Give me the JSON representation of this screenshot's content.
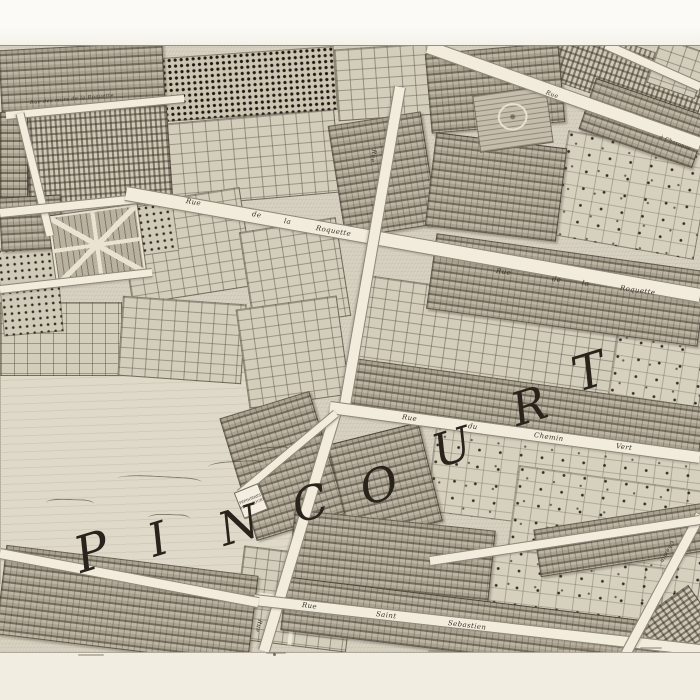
{
  "map": {
    "district_word": "PINCOURT",
    "letters": [
      {
        "ch": "P",
        "x": 92,
        "y": 552,
        "size": 50,
        "rot": -17
      },
      {
        "ch": "I",
        "x": 158,
        "y": 539,
        "size": 46,
        "rot": -17
      },
      {
        "ch": "N",
        "x": 239,
        "y": 525,
        "size": 46,
        "rot": -17
      },
      {
        "ch": "C",
        "x": 310,
        "y": 503,
        "size": 46,
        "rot": -17
      },
      {
        "ch": "O",
        "x": 379,
        "y": 485,
        "size": 46,
        "rot": -17
      },
      {
        "ch": "U",
        "x": 452,
        "y": 447,
        "size": 46,
        "rot": -17
      },
      {
        "ch": "R",
        "x": 529,
        "y": 406,
        "size": 46,
        "rot": -17
      },
      {
        "ch": "T",
        "x": 589,
        "y": 372,
        "size": 48,
        "rot": -17
      }
    ],
    "streets": [
      {
        "name": "Rue des murs de la Roquette",
        "x1": 6,
        "y1": 114,
        "x2": 184,
        "y2": 97,
        "w": 7
      },
      {
        "name": "",
        "x1": 20,
        "y1": 112,
        "x2": 50,
        "y2": 234,
        "w": 7
      },
      {
        "name": "",
        "x1": 0,
        "y1": 212,
        "x2": 148,
        "y2": 197,
        "w": 8
      },
      {
        "name": "",
        "x1": 0,
        "y1": 288,
        "x2": 152,
        "y2": 271,
        "w": 7
      },
      {
        "name": "Rue de la Roquette",
        "x1": 126,
        "y1": 192,
        "x2": 700,
        "y2": 294,
        "w": 13
      },
      {
        "name": "",
        "x1": 428,
        "y1": 46,
        "x2": 700,
        "y2": 143,
        "w": 12
      },
      {
        "name": "",
        "x1": 606,
        "y1": 44,
        "x2": 700,
        "y2": 86,
        "w": 8
      },
      {
        "name": "",
        "x1": 400,
        "y1": 86,
        "x2": 345,
        "y2": 404,
        "w": 10
      },
      {
        "name": "",
        "x1": 338,
        "y1": 404,
        "x2": 264,
        "y2": 650,
        "w": 10
      },
      {
        "name": "Rue du Chemin Vert",
        "x1": 330,
        "y1": 406,
        "x2": 700,
        "y2": 456,
        "w": 11
      },
      {
        "name": "Rue Saint Sebastien",
        "x1": 254,
        "y1": 599,
        "x2": 700,
        "y2": 649,
        "w": 10
      },
      {
        "name": "",
        "x1": 0,
        "y1": 552,
        "x2": 258,
        "y2": 601,
        "w": 9
      },
      {
        "name": "Chemin",
        "x1": 626,
        "y1": 652,
        "x2": 700,
        "y2": 514,
        "w": 9
      },
      {
        "name": "",
        "x1": 240,
        "y1": 492,
        "x2": 336,
        "y2": 412,
        "w": 7
      },
      {
        "name": "",
        "x1": 430,
        "y1": 560,
        "x2": 700,
        "y2": 519,
        "w": 8
      }
    ],
    "labels": [
      {
        "text": "Rue des murs de la Roquette",
        "x": 30,
        "y": 100,
        "rot": -5,
        "size": 5
      },
      {
        "text": "Rue",
        "x": 186,
        "y": 197,
        "rot": 10,
        "size": 7
      },
      {
        "text": "de",
        "x": 252,
        "y": 210,
        "rot": 10,
        "size": 7
      },
      {
        "text": "la",
        "x": 284,
        "y": 217,
        "rot": 10,
        "size": 7
      },
      {
        "text": "Roquette",
        "x": 316,
        "y": 224,
        "rot": 10,
        "size": 7
      },
      {
        "text": "Rue",
        "x": 496,
        "y": 267,
        "rot": 8,
        "size": 7
      },
      {
        "text": "de",
        "x": 552,
        "y": 275,
        "rot": 8,
        "size": 7
      },
      {
        "text": "la",
        "x": 582,
        "y": 279,
        "rot": 8,
        "size": 7
      },
      {
        "text": "Roquette",
        "x": 620,
        "y": 284,
        "rot": 8,
        "size": 7
      },
      {
        "text": "Rue",
        "x": 402,
        "y": 413,
        "rot": 8,
        "size": 7
      },
      {
        "text": "du",
        "x": 468,
        "y": 422,
        "rot": 8,
        "size": 7
      },
      {
        "text": "Chemin",
        "x": 534,
        "y": 431,
        "rot": 8,
        "size": 7
      },
      {
        "text": "Vert",
        "x": 616,
        "y": 442,
        "rot": 8,
        "size": 7
      },
      {
        "text": "Rue",
        "x": 302,
        "y": 601,
        "rot": 7,
        "size": 7
      },
      {
        "text": "Saint",
        "x": 376,
        "y": 610,
        "rot": 7,
        "size": 7
      },
      {
        "text": "Sebastien",
        "x": 448,
        "y": 619,
        "rot": 7,
        "size": 7
      },
      {
        "text": "Rue",
        "x": 260,
        "y": 616,
        "rot": 104,
        "size": 6
      },
      {
        "text": "Rue",
        "x": 374,
        "y": 146,
        "rot": 98,
        "size": 6
      },
      {
        "text": "Rue",
        "x": 546,
        "y": 89,
        "rot": 20,
        "size": 6
      },
      {
        "text": "à Charonne",
        "x": 660,
        "y": 134,
        "rot": 22,
        "size": 5
      },
      {
        "text": "Chemin",
        "x": 672,
        "y": 538,
        "rot": 118,
        "size": 5.5
      }
    ],
    "plaque": {
      "x": 238,
      "y": 487,
      "w": 24,
      "h": 26,
      "rot": -22,
      "lines": [
        "PEPINIERES",
        "DE PINCOURT"
      ]
    },
    "blocks": [
      {
        "x": 0,
        "y": 372,
        "w": 292,
        "h": 210,
        "rot": 0,
        "type": "field"
      },
      {
        "x": 336,
        "y": 46,
        "w": 96,
        "h": 70,
        "rot": -4,
        "type": "grid"
      },
      {
        "x": 545,
        "y": 44,
        "w": 160,
        "h": 58,
        "rot": 19,
        "type": "vineyard"
      },
      {
        "x": 652,
        "y": 44,
        "w": 50,
        "h": 46,
        "rot": 19,
        "type": "grid"
      },
      {
        "x": 168,
        "y": 116,
        "w": 168,
        "h": 82,
        "rot": -5,
        "type": "grid"
      },
      {
        "x": 124,
        "y": 196,
        "w": 122,
        "h": 98,
        "rot": -9,
        "type": "grid"
      },
      {
        "x": 246,
        "y": 224,
        "w": 96,
        "h": 98,
        "rot": -9,
        "type": "grid"
      },
      {
        "x": 0,
        "y": 302,
        "w": 120,
        "h": 72,
        "rot": 0,
        "type": "grid"
      },
      {
        "x": 120,
        "y": 300,
        "w": 122,
        "h": 78,
        "rot": 4,
        "type": "grid"
      },
      {
        "x": 242,
        "y": 302,
        "w": 100,
        "h": 98,
        "rot": -8,
        "type": "grid"
      },
      {
        "x": 352,
        "y": 292,
        "w": 262,
        "h": 112,
        "rot": 8,
        "type": "grid"
      },
      {
        "x": 558,
        "y": 142,
        "w": 144,
        "h": 104,
        "rot": 10,
        "type": "scatter"
      },
      {
        "x": 612,
        "y": 308,
        "w": 90,
        "h": 124,
        "rot": 9,
        "type": "scatter"
      },
      {
        "x": 430,
        "y": 440,
        "w": 272,
        "h": 86,
        "rot": 7,
        "type": "scatter"
      },
      {
        "x": 508,
        "y": 478,
        "w": 194,
        "h": 142,
        "rot": 8,
        "type": "scatter"
      },
      {
        "x": 470,
        "y": 556,
        "w": 190,
        "h": 84,
        "rot": 7,
        "type": "scatter"
      },
      {
        "x": 238,
        "y": 552,
        "w": 112,
        "h": 92,
        "rot": 7,
        "type": "cross"
      },
      {
        "x": 162,
        "y": 52,
        "w": 172,
        "h": 62,
        "rot": -4,
        "type": "orchard-dense"
      },
      {
        "x": 26,
        "y": 110,
        "w": 142,
        "h": 88,
        "rot": -4,
        "type": "vineyard"
      },
      {
        "x": 0,
        "y": 246,
        "w": 58,
        "h": 86,
        "rot": -5,
        "type": "orchard"
      },
      {
        "x": 132,
        "y": 204,
        "w": 42,
        "h": 48,
        "rot": -8,
        "type": "orchard"
      },
      {
        "x": 0,
        "y": 46,
        "w": 162,
        "h": 62,
        "rot": -3,
        "type": "houses"
      },
      {
        "x": 428,
        "y": 48,
        "w": 132,
        "h": 78,
        "rot": -5,
        "type": "houses"
      },
      {
        "x": 584,
        "y": 96,
        "w": 118,
        "h": 52,
        "rot": 19,
        "type": "houses"
      },
      {
        "x": 0,
        "y": 112,
        "w": 26,
        "h": 86,
        "rot": 0,
        "type": "houses"
      },
      {
        "x": 336,
        "y": 118,
        "w": 92,
        "h": 112,
        "rot": -9,
        "type": "houses"
      },
      {
        "x": 430,
        "y": 140,
        "w": 130,
        "h": 92,
        "rot": 7,
        "type": "houses"
      },
      {
        "x": 0,
        "y": 196,
        "w": 60,
        "h": 52,
        "rot": -3,
        "type": "houses"
      },
      {
        "x": 430,
        "y": 252,
        "w": 272,
        "h": 74,
        "rot": 8,
        "type": "houses"
      },
      {
        "x": 342,
        "y": 382,
        "w": 360,
        "h": 46,
        "rot": 8,
        "type": "houses"
      },
      {
        "x": 236,
        "y": 402,
        "w": 92,
        "h": 126,
        "rot": -17,
        "type": "houses"
      },
      {
        "x": 338,
        "y": 432,
        "w": 92,
        "h": 100,
        "rot": -14,
        "type": "houses"
      },
      {
        "x": 290,
        "y": 520,
        "w": 200,
        "h": 80,
        "rot": 6,
        "type": "houses"
      },
      {
        "x": 536,
        "y": 516,
        "w": 170,
        "h": 46,
        "rot": -9,
        "type": "houses"
      },
      {
        "x": 0,
        "y": 560,
        "w": 252,
        "h": 88,
        "rot": 7,
        "type": "houses"
      },
      {
        "x": 282,
        "y": 602,
        "w": 420,
        "h": 52,
        "rot": 7,
        "type": "houses"
      },
      {
        "x": 650,
        "y": 594,
        "w": 54,
        "h": 62,
        "rot": 55,
        "type": "vineyard"
      },
      {
        "x": 52,
        "y": 210,
        "w": 86,
        "h": 66,
        "rot": -8,
        "type": "parterre-x"
      },
      {
        "x": 476,
        "y": 90,
        "w": 72,
        "h": 56,
        "rot": -8,
        "type": "parterre-oval"
      }
    ],
    "ridges": [
      {
        "x": 118,
        "y": 476,
        "w": 84,
        "rot": 3
      },
      {
        "x": 208,
        "y": 461,
        "w": 56,
        "rot": -3
      },
      {
        "x": 46,
        "y": 499,
        "w": 48,
        "rot": 2
      },
      {
        "x": 148,
        "y": 514,
        "w": 42,
        "rot": 2
      },
      {
        "x": 250,
        "y": 447,
        "w": 40,
        "rot": -4
      }
    ],
    "paper_marks": [
      {
        "x": 78,
        "y": 654,
        "w": 26
      },
      {
        "x": 266,
        "y": 652,
        "w": 20
      },
      {
        "x": 428,
        "y": 650,
        "w": 30
      },
      {
        "x": 558,
        "y": 648,
        "w": 36
      },
      {
        "x": 640,
        "y": 647,
        "w": 22
      },
      {
        "x": 273,
        "y": 653,
        "w": 3,
        "dot": true
      }
    ],
    "palette": {
      "paper": "#f7f5ef",
      "paper_bottom": "#f1ede0",
      "map_base": "#d8d2c2",
      "street": "#f1ecdc",
      "ink": "#39342a",
      "letter_ink": "#28241c"
    }
  }
}
